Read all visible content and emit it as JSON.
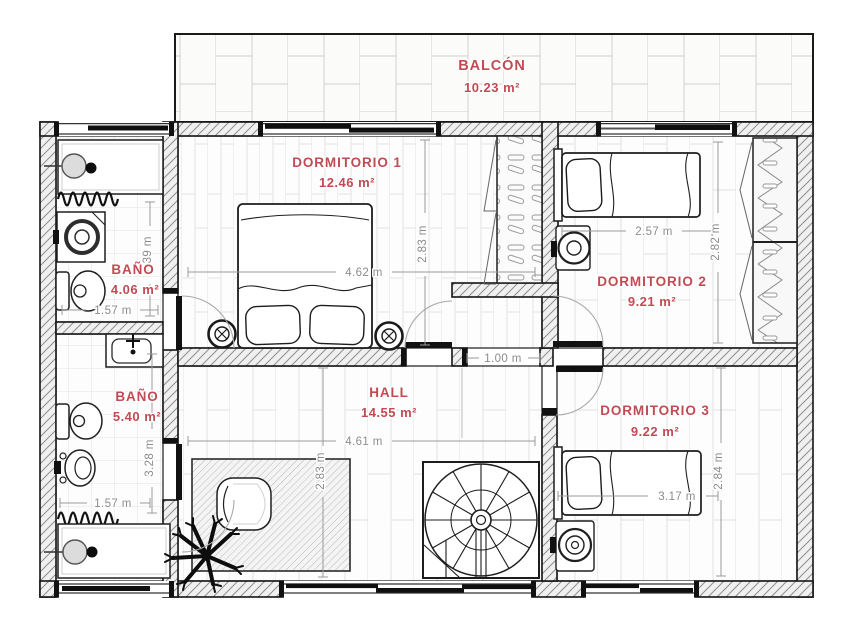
{
  "colors": {
    "room_label": "#c14b53",
    "dimension_text": "#8c8c8c",
    "walls": "#141414",
    "floor_lines": "#e2e2e2"
  },
  "rooms": [
    {
      "name": "BALCÓN",
      "area": "10.23 m²"
    },
    {
      "name": "DORMITORIO 1",
      "area": "12.46 m²"
    },
    {
      "name": "DORMITORIO 2",
      "area": "9.21 m²"
    },
    {
      "name": "BAÑO",
      "area": "4.06 m²"
    },
    {
      "name": "HALL",
      "area": "14.55 m²"
    },
    {
      "name": "BAÑO",
      "area": "5.40 m²"
    },
    {
      "name": "DORMITORIO 3",
      "area": "9.22 m²"
    }
  ],
  "dimensions": [
    {
      "label": "2.39 m"
    },
    {
      "label": "1.57 m"
    },
    {
      "label": "2.83 m"
    },
    {
      "label": "4.62 m"
    },
    {
      "label": "2.57 m"
    },
    {
      "label": "2.82 m"
    },
    {
      "label": "1.00 m"
    },
    {
      "label": "3.28 m"
    },
    {
      "label": "4.61 m"
    },
    {
      "label": "2.83 m"
    },
    {
      "label": "3.17 m"
    },
    {
      "label": "2.84 m"
    },
    {
      "label": "1.57 m"
    }
  ]
}
